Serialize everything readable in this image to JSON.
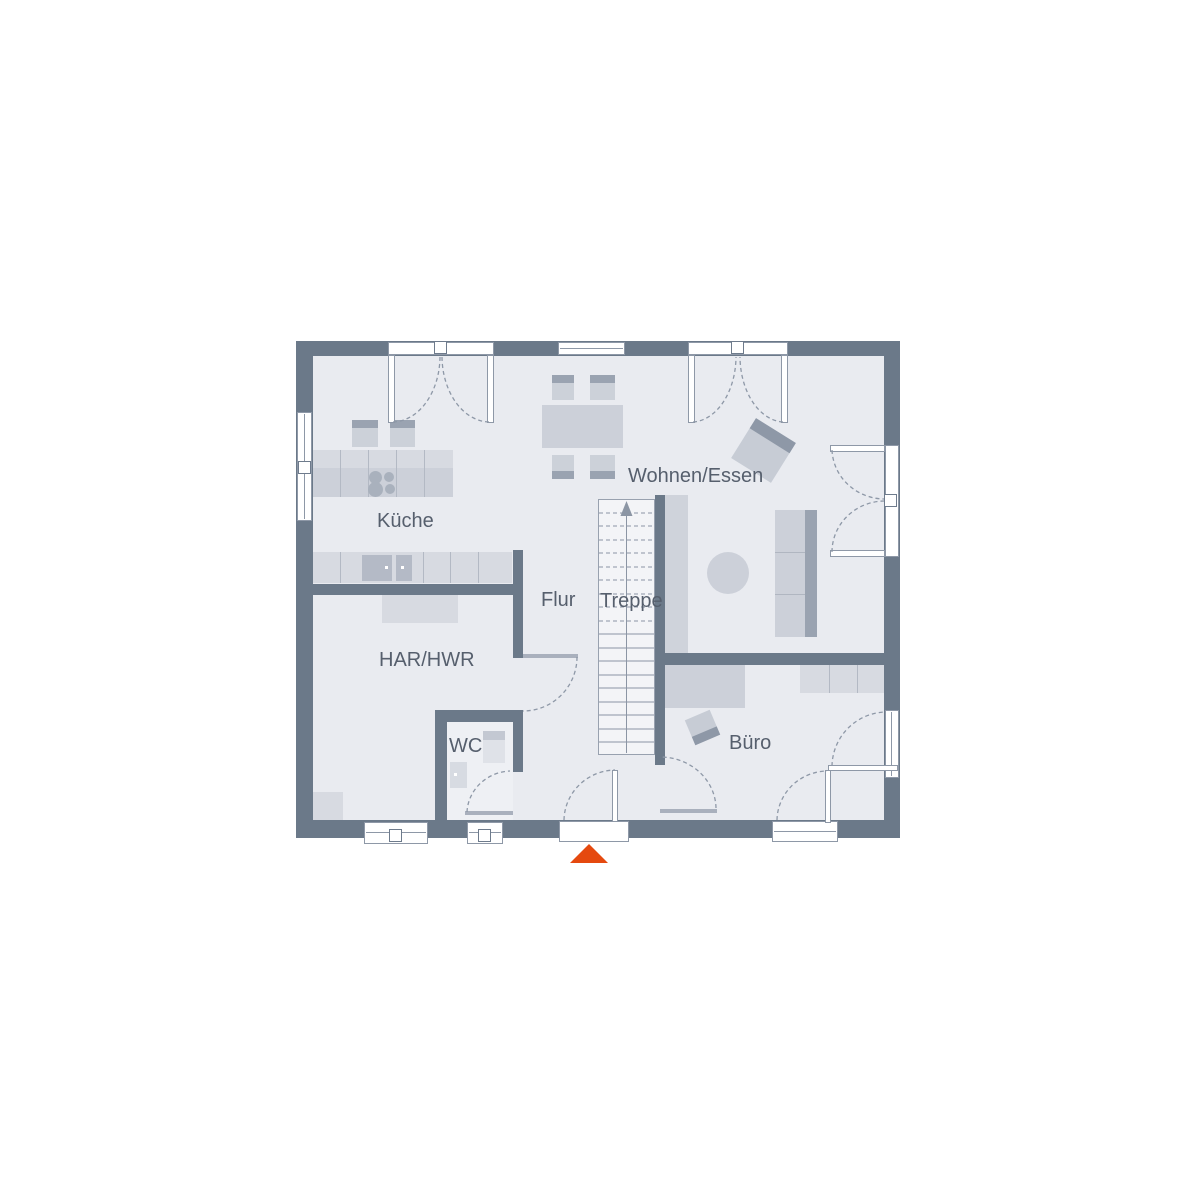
{
  "plan": {
    "type": "floor-plan",
    "rooms": {
      "kueche": {
        "label": "Küche"
      },
      "wohnen_essen": {
        "label": "Wohnen/Essen"
      },
      "flur": {
        "label": "Flur"
      },
      "treppe": {
        "label": "Treppe"
      },
      "har_hwr": {
        "label": "HAR/HWR"
      },
      "wc": {
        "label": "WC"
      },
      "buero": {
        "label": "Büro"
      }
    },
    "fixtures": [
      "kitchen-island-with-cooktop",
      "bar-stool",
      "bar-stool",
      "kitchen-counter-with-sink",
      "dining-table",
      "dining-chair",
      "dining-chair",
      "dining-chair",
      "dining-chair",
      "armchair",
      "sofa",
      "round-coffee-table",
      "staircase-up",
      "storage-shelf",
      "wc-vanity",
      "toilet",
      "desk",
      "office-shelf",
      "office-chair"
    ],
    "icons": {
      "entrance_marker": "orange-triangle-entrance-icon",
      "stair_direction": "up-arrow-icon",
      "window_handle": "square-handle-icon"
    },
    "colors": {
      "wall": "#6b7989",
      "floor": "#e9ebf0",
      "stairs_floor": "#f3f4f7",
      "furniture_light": "#d7dae1",
      "furniture_mid": "#ccd0d9",
      "furniture_dark": "#9aa3b1",
      "outline": "#8e98a7",
      "label_text": "#565f6d",
      "entrance_accent": "#e5490f"
    }
  }
}
